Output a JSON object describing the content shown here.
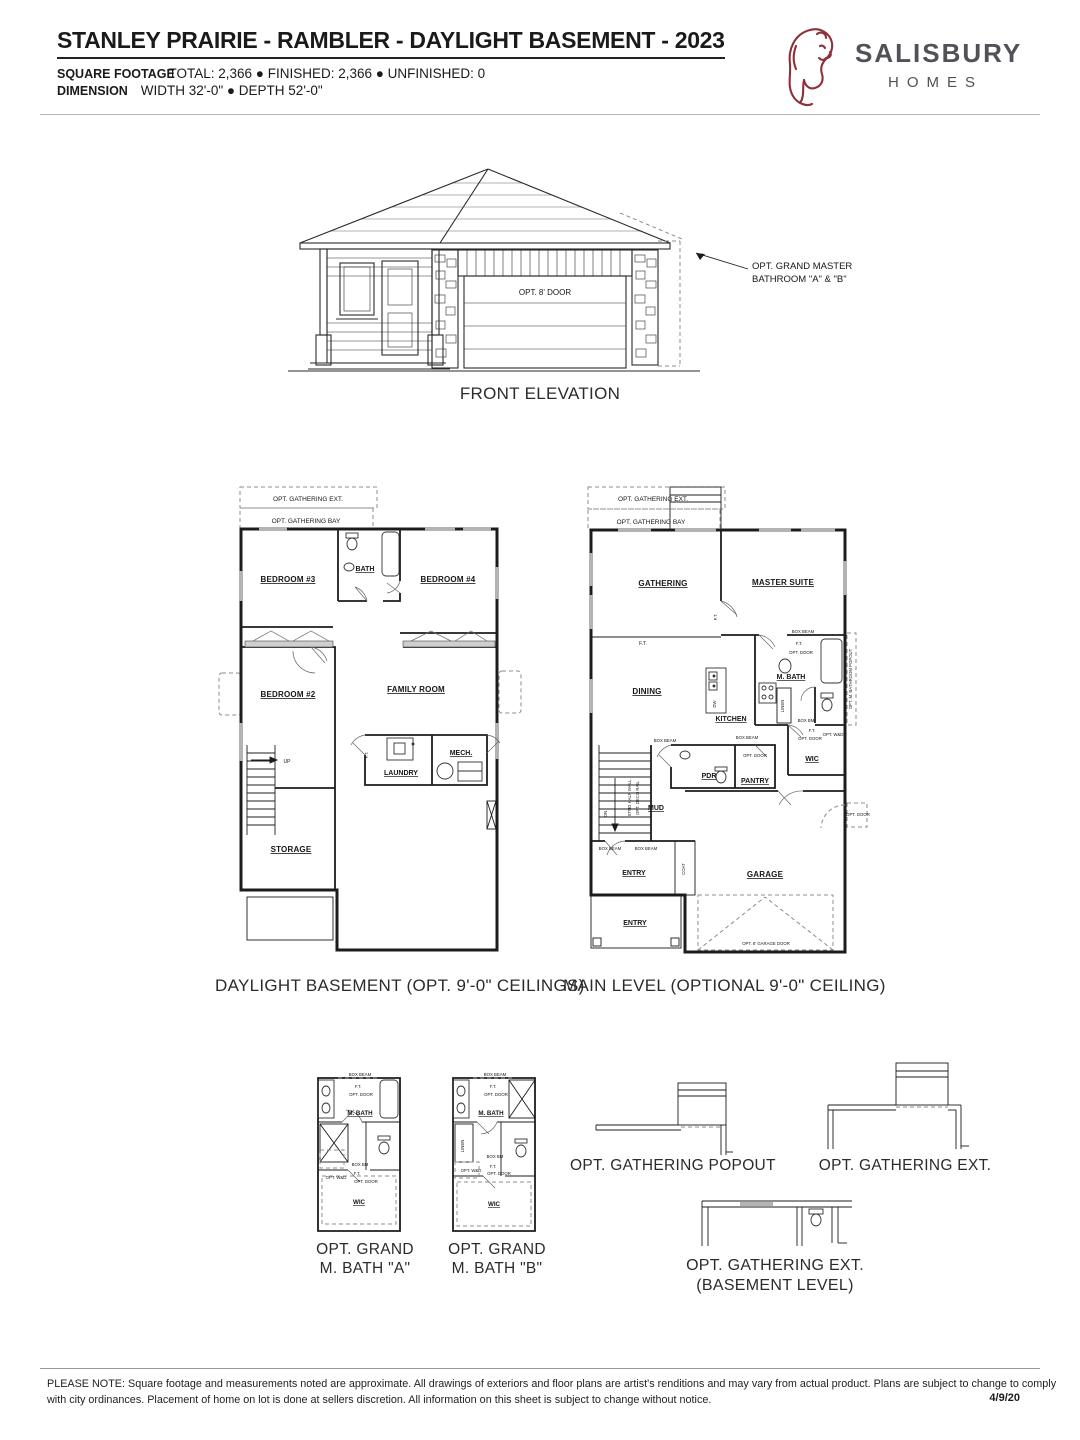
{
  "header": {
    "title": "STANLEY PRAIRIE - RAMBLER - DAYLIGHT BASEMENT - 2023",
    "square_footage": {
      "label": "SQUARE FOOTAGE",
      "value": "TOTAL: 2,366 ● FINISHED: 2,366 ● UNFINISHED: 0"
    },
    "dimension": {
      "label": "DIMENSION",
      "value": "WIDTH 32'-0\" ● DEPTH 52'-0\""
    },
    "logo": {
      "brand": "SALISBURY",
      "suffix": "HOMES",
      "icon": "lion-head-sketch",
      "accent_color": "#8e3039",
      "text_color": "#515157"
    }
  },
  "elevation": {
    "caption": "FRONT ELEVATION",
    "garage_door_label": "OPT. 8' DOOR",
    "annotation_line1": "OPT. GRAND MASTER",
    "annotation_line2": "BATHROOM \"A\" & \"B\""
  },
  "basement": {
    "caption": "DAYLIGHT BASEMENT (OPT. 9'-0\" CEILINGS)",
    "opt_gathering_ext": "OPT. GATHERING EXT.",
    "opt_gathering_bay": "OPT. GATHERING BAY",
    "bedroom_3": "BEDROOM #3",
    "bath": "BATH",
    "bedroom_4": "BEDROOM #4",
    "bedroom_2": "BEDROOM #2",
    "family_room": "FAMILY ROOM",
    "up": "UP",
    "ft": "F.T.",
    "laundry": "LAUNDRY",
    "mech": "MECH.",
    "storage": "STORAGE"
  },
  "main": {
    "caption": "MAIN LEVEL (OPTIONAL 9'-0\" CEILING)",
    "opt_gathering_ext": "OPT. GATHERING EXT.",
    "opt_gathering_bay": "OPT. GATHERING BAY",
    "gathering": "GATHERING",
    "master_suite": "MASTER SUITE",
    "ft": "F.T.",
    "box_beam": "BOX BEAM",
    "box_bm": "BOX BM",
    "opt_door": "OPT. DOOR",
    "m_bath": "M. BATH",
    "opt_m_bath_popout": "OPT. M. BATHROOM POPOUT",
    "dining": "DINING",
    "kitchen": "KITCHEN",
    "dw": "DW",
    "linen": "LINEN",
    "opt_wd": "OPT. W&D",
    "wic": "WIC",
    "pdr": "PDR",
    "pantry": "PANTRY",
    "mud": "MUD",
    "dn": "DN",
    "stair_note_1": "STND HALF WALL",
    "stair_note_2": "OPT. DECO RAIL",
    "entry": "ENTRY",
    "coat": "COAT",
    "garage": "GARAGE",
    "opt_garage_door": "OPT. 8' GARAGE DOOR"
  },
  "options": {
    "labels": {
      "box_beam": "BOX BEAM",
      "box_bm": "BOX BM",
      "ft": "F.T.",
      "opt_door": "OPT. DOOR",
      "m_bath": "M. BATH",
      "opt_wd": "OPT. W&D",
      "wic": "WIC",
      "linen": "LINEN"
    },
    "bath_a": {
      "caption_1": "OPT. GRAND",
      "caption_2": "M. BATH \"A\""
    },
    "bath_b": {
      "caption_1": "OPT. GRAND",
      "caption_2": "M. BATH \"B\""
    },
    "gathering_popout_caption": "OPT. GATHERING POPOUT",
    "gathering_ext_caption": "OPT. GATHERING EXT.",
    "gathering_ext_basement_caption_1": "OPT. GATHERING EXT.",
    "gathering_ext_basement_caption_2": "(BASEMENT LEVEL)"
  },
  "footer": {
    "note_line1": "PLEASE NOTE: Square footage and measurements noted are approximate. All drawings of exteriors and floor plans are artist's renditions and may vary from actual product. Plans are subject to change to comply",
    "note_line2": "with city ordinances. Placement of home on lot is done at sellers discretion. All information on this sheet is subject to change without notice.",
    "date": "4/9/20"
  }
}
